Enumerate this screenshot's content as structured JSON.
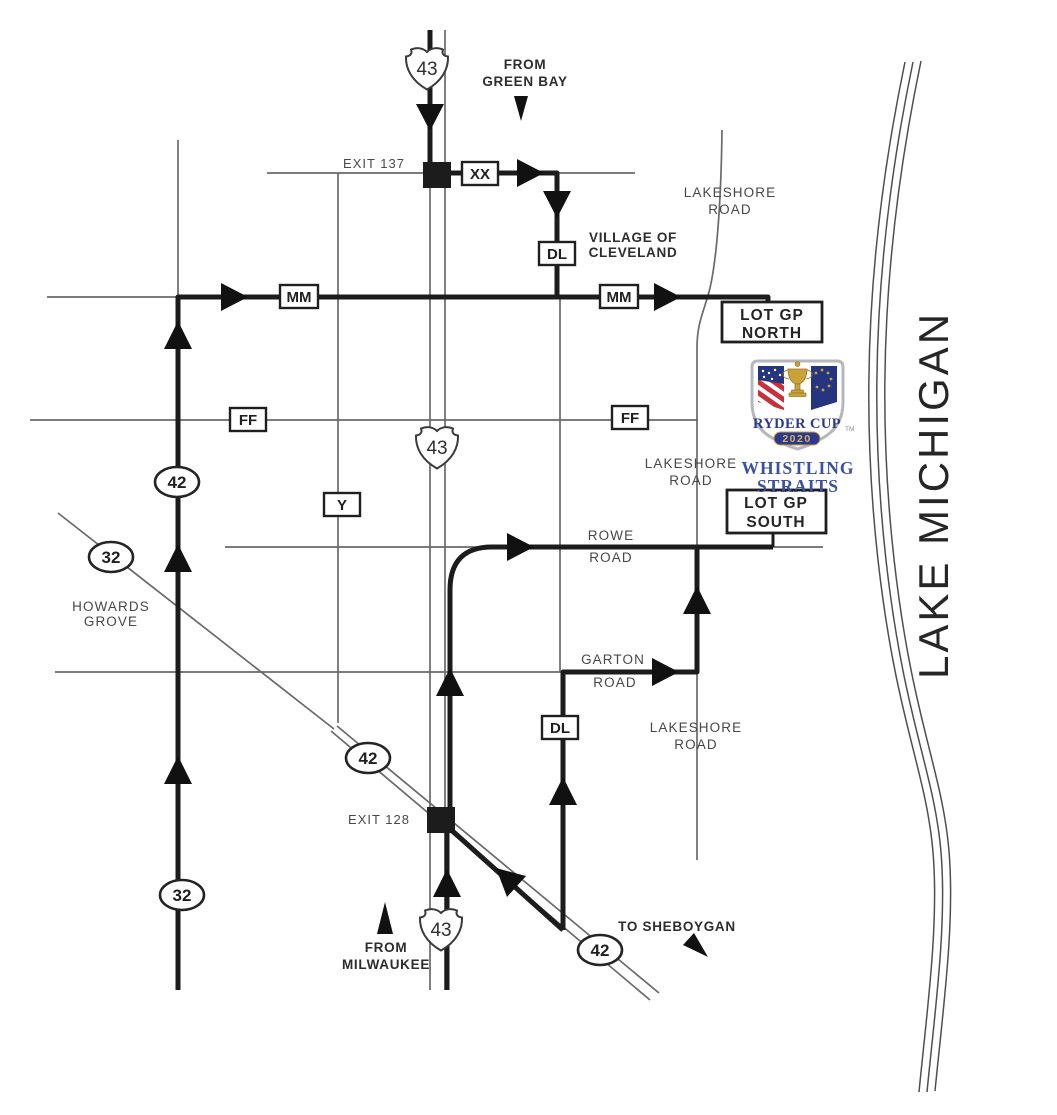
{
  "water_label": "LAKE MICHIGAN",
  "travel_labels": {
    "from_green_bay": {
      "line1": "FROM",
      "line2": "GREEN BAY"
    },
    "from_milwaukee": {
      "line1": "FROM",
      "line2": "MILWAUKEE"
    },
    "to_sheboygan": "TO SHEBOYGAN"
  },
  "exit_labels": {
    "exit_137": "EXIT 137",
    "exit_128": "EXIT 128"
  },
  "place_labels": {
    "village_of_cleveland": {
      "line1": "VILLAGE OF",
      "line2": "CLEVELAND"
    },
    "howards_grove": {
      "line1": "HOWARDS",
      "line2": "GROVE"
    }
  },
  "road_labels": {
    "lakeshore_north": {
      "line1": "LAKESHORE",
      "line2": "ROAD"
    },
    "lakeshore_mid": {
      "line1": "LAKESHORE",
      "line2": "ROAD"
    },
    "lakeshore_south": {
      "line1": "LAKESHORE",
      "line2": "ROAD"
    },
    "rowe": {
      "line1": "ROWE",
      "line2": "ROAD"
    },
    "garton": {
      "line1": "GARTON",
      "line2": "ROAD"
    }
  },
  "parking_lots": {
    "north": {
      "line1": "LOT GP",
      "line2": "NORTH"
    },
    "south": {
      "line1": "LOT GP",
      "line2": "SOUTH"
    }
  },
  "highway_shields": {
    "i43_top": "43",
    "i43_mid": "43",
    "i43_bottom": "43",
    "wi42_west": "42",
    "wi42_exit": "42",
    "wi42_southeast": "42",
    "wi32_diagonal": "32",
    "wi32_south": "32"
  },
  "county_markers": {
    "xx": "XX",
    "dl_north": "DL",
    "dl_south": "DL",
    "mm_west": "MM",
    "mm_east": "MM",
    "ff_west": "FF",
    "ff_east": "FF",
    "y": "Y"
  },
  "logo": {
    "event_name": "RYDER CUP",
    "year": "2020",
    "trademark": "TM",
    "venue": {
      "line1": "WHISTLING",
      "line2": "STRAITS"
    }
  },
  "colors": {
    "route_bold": "#1c1c1c",
    "road_thin": "#6a6a6a",
    "logo_blue": "#2b3a8f",
    "logo_gold": "#c9a23a",
    "logo_red": "#c8313c",
    "venue_blue": "#3a50a2"
  }
}
